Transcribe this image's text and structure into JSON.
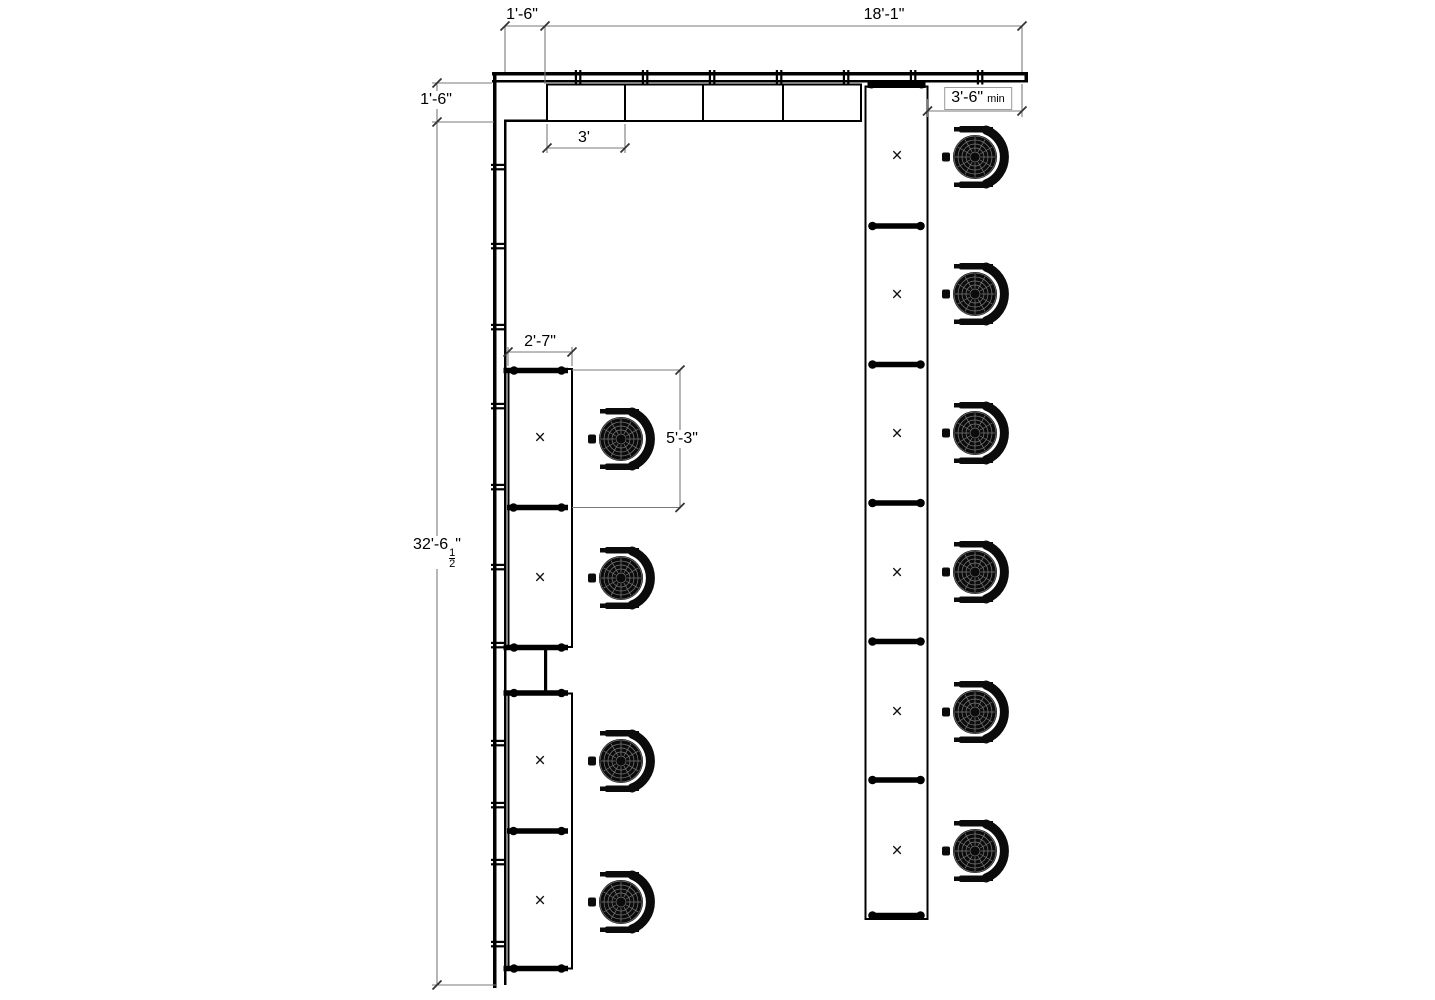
{
  "dimensions": {
    "top_offset": "1'-6\"",
    "top_span": "18'-1\"",
    "left_offset": "1'-6\"",
    "left_span_whole": "32'-6",
    "left_span_frac_num": "1",
    "left_span_frac_den": "2",
    "left_span_unit": "\"",
    "cabinet_module": "3'",
    "clearance": "3'-6\"",
    "clearance_qualifier": "min",
    "desk_width": "2'-7\"",
    "workstation_pitch": "5'-3\""
  },
  "markers": {
    "workstation": "×"
  },
  "colors": {
    "ink": "#000000",
    "dimension_line": "#7a7a7a"
  }
}
